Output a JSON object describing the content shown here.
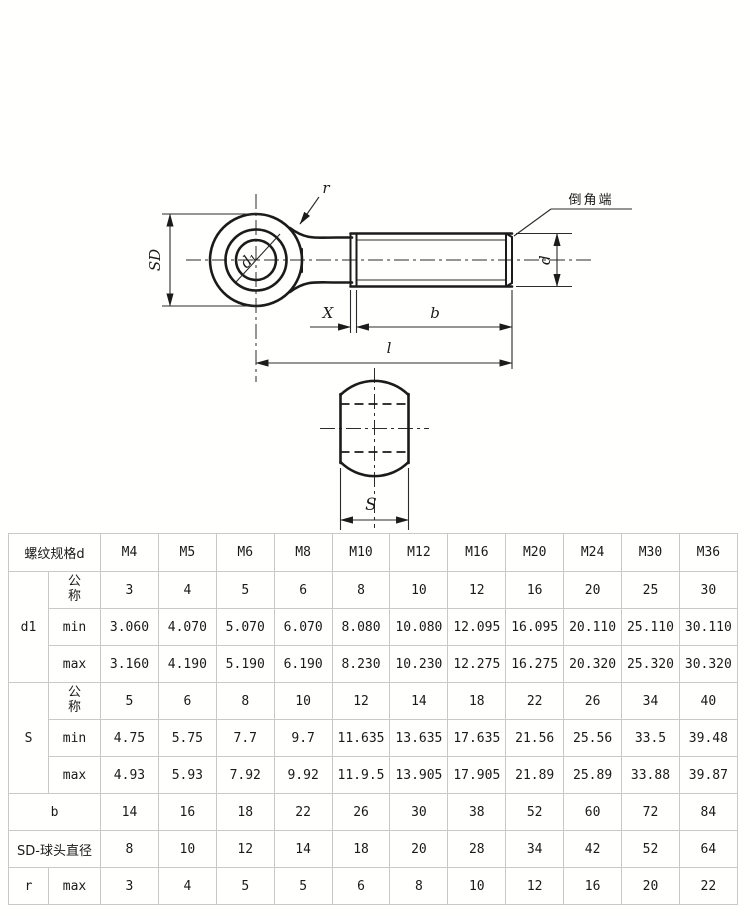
{
  "drawing": {
    "labels": {
      "fillet_radius": "r",
      "chamfer_end": "倒角端",
      "head_diameter": "SD",
      "hole_diameter": "d₁",
      "thread_diameter": "d",
      "thread_runout": "X",
      "thread_length": "b",
      "total_length": "l",
      "width_across_flats": "S"
    }
  },
  "table": {
    "header": {
      "spec_label": "螺纹规格d",
      "sizes": [
        "M4",
        "M5",
        "M6",
        "M8",
        "M10",
        "M12",
        "M16",
        "M20",
        "M24",
        "M30",
        "M36"
      ]
    },
    "row_labels": {
      "d1": "d1",
      "s": "S",
      "b": "b",
      "sd": "SD-球头直径",
      "r": "r",
      "nominal": "公称",
      "min": "min",
      "max": "max"
    },
    "values": {
      "d1_nominal": [
        "3",
        "4",
        "5",
        "6",
        "8",
        "10",
        "12",
        "16",
        "20",
        "25",
        "30"
      ],
      "d1_min": [
        "3.060",
        "4.070",
        "5.070",
        "6.070",
        "8.080",
        "10.080",
        "12.095",
        "16.095",
        "20.110",
        "25.110",
        "30.110"
      ],
      "d1_max": [
        "3.160",
        "4.190",
        "5.190",
        "6.190",
        "8.230",
        "10.230",
        "12.275",
        "16.275",
        "20.320",
        "25.320",
        "30.320"
      ],
      "s_nominal": [
        "5",
        "6",
        "8",
        "10",
        "12",
        "14",
        "18",
        "22",
        "26",
        "34",
        "40"
      ],
      "s_min": [
        "4.75",
        "5.75",
        "7.7",
        "9.7",
        "11.635",
        "13.635",
        "17.635",
        "21.56",
        "25.56",
        "33.5",
        "39.48"
      ],
      "s_max": [
        "4.93",
        "5.93",
        "7.92",
        "9.92",
        "11.9.5",
        "13.905",
        "17.905",
        "21.89",
        "25.89",
        "33.88",
        "39.87"
      ],
      "b": [
        "14",
        "16",
        "18",
        "22",
        "26",
        "30",
        "38",
        "52",
        "60",
        "72",
        "84"
      ],
      "sd": [
        "8",
        "10",
        "12",
        "14",
        "18",
        "20",
        "28",
        "34",
        "42",
        "52",
        "64"
      ],
      "r_max": [
        "3",
        "4",
        "5",
        "5",
        "6",
        "8",
        "10",
        "12",
        "16",
        "20",
        "22"
      ]
    }
  }
}
